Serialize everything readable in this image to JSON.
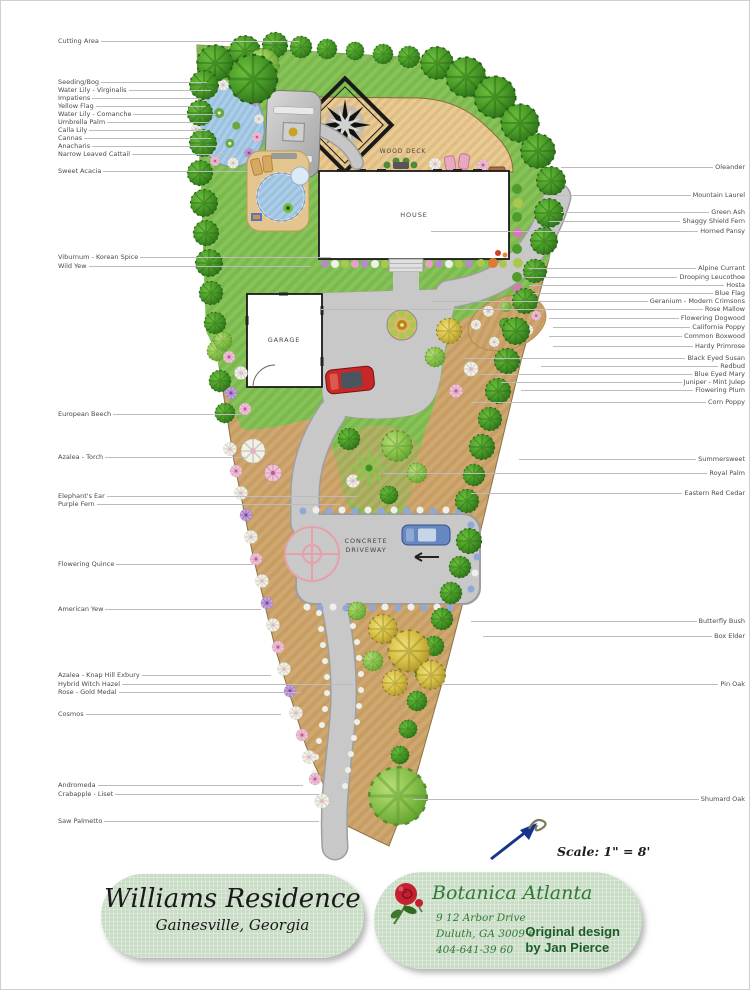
{
  "plan": {
    "scale_text": "Scale: 1\" = 8'",
    "structures": {
      "house": "HOUSE",
      "garage": "GARAGE",
      "wood_deck": "WOOD DECK",
      "driveway_line1": "CONCRETE",
      "driveway_line2": "DRIVEWAY"
    },
    "plant_labels": {
      "left": [
        {
          "text": "Cutting Area",
          "y": 40,
          "to": 298
        },
        {
          "text": "Seeding/Bog",
          "y": 81,
          "to": 206
        },
        {
          "text": "Water Lily - Virginalis",
          "y": 89,
          "to": 210
        },
        {
          "text": "Impatiens",
          "y": 97,
          "to": 200
        },
        {
          "text": "Yellow Flag",
          "y": 105,
          "to": 205
        },
        {
          "text": "Water Lily - Comanche",
          "y": 113,
          "to": 215
        },
        {
          "text": "Umbrella Palm",
          "y": 121,
          "to": 210
        },
        {
          "text": "Calla Lily",
          "y": 129,
          "to": 206
        },
        {
          "text": "Cannas",
          "y": 137,
          "to": 210
        },
        {
          "text": "Anacharis",
          "y": 145,
          "to": 216
        },
        {
          "text": "Narrow Leaved Cattail",
          "y": 153,
          "to": 230
        },
        {
          "text": "Sweet Acacia",
          "y": 170,
          "to": 246
        },
        {
          "text": "Viburnum - Korean Spice",
          "y": 256,
          "to": 330
        },
        {
          "text": "Wild Yew",
          "y": 265,
          "to": 310
        },
        {
          "text": "European Beech",
          "y": 413,
          "to": 240
        },
        {
          "text": "Azalea - Torch",
          "y": 456,
          "to": 244
        },
        {
          "text": "Elephant's Ear",
          "y": 495,
          "to": 356
        },
        {
          "text": "Purple Fern",
          "y": 503,
          "to": 340
        },
        {
          "text": "Flowering Quince",
          "y": 563,
          "to": 252
        },
        {
          "text": "American Yew",
          "y": 608,
          "to": 260
        },
        {
          "text": "Azalea - Knap Hill Exbury",
          "y": 674,
          "to": 270
        },
        {
          "text": "Hybrid Witch Hazel",
          "y": 683,
          "to": 352
        },
        {
          "text": "Rose - Gold Medal",
          "y": 691,
          "to": 300
        },
        {
          "text": "Cosmos",
          "y": 713,
          "to": 280
        },
        {
          "text": "Andromeda",
          "y": 784,
          "to": 302
        },
        {
          "text": "Crabapple - Liset",
          "y": 793,
          "to": 318
        },
        {
          "text": "Saw Palmetto",
          "y": 820,
          "to": 318
        }
      ],
      "right": [
        {
          "text": "Oleander",
          "y": 166,
          "from": 560
        },
        {
          "text": "Mountain Laurel",
          "y": 194,
          "from": 545
        },
        {
          "text": "Green Ash",
          "y": 211,
          "from": 560
        },
        {
          "text": "Shaggy Shield Fern",
          "y": 220,
          "from": 548
        },
        {
          "text": "Horned Pansy",
          "y": 230,
          "from": 430
        },
        {
          "text": "Alpine Currant",
          "y": 267,
          "from": 528
        },
        {
          "text": "Drooping Leucothoe",
          "y": 276,
          "from": 524
        },
        {
          "text": "Hosta",
          "y": 284,
          "from": 528
        },
        {
          "text": "Blue Flag",
          "y": 292,
          "from": 532
        },
        {
          "text": "Geranium - Modern Crimsons",
          "y": 300,
          "from": 430
        },
        {
          "text": "Rose Mallow",
          "y": 308,
          "from": 320
        },
        {
          "text": "Flowering Dogwood",
          "y": 317,
          "from": 548
        },
        {
          "text": "California Poppy",
          "y": 326,
          "from": 552
        },
        {
          "text": "Common Boxwood",
          "y": 335,
          "from": 548
        },
        {
          "text": "Hardy Primrose",
          "y": 345,
          "from": 552
        },
        {
          "text": "Black Eyed Susan",
          "y": 357,
          "from": 462
        },
        {
          "text": "Redbud",
          "y": 365,
          "from": 540
        },
        {
          "text": "Blue Eyed Mary",
          "y": 373,
          "from": 480
        },
        {
          "text": "Juniper - Mint Julep",
          "y": 381,
          "from": 500
        },
        {
          "text": "Flowering Plum",
          "y": 389,
          "from": 520
        },
        {
          "text": "Corn Poppy",
          "y": 401,
          "from": 470
        },
        {
          "text": "Summersweet",
          "y": 458,
          "from": 518
        },
        {
          "text": "Royal Palm",
          "y": 472,
          "from": 382
        },
        {
          "text": "Eastern Red Cedar",
          "y": 492,
          "from": 470
        },
        {
          "text": "Butterfly Bush",
          "y": 620,
          "from": 470
        },
        {
          "text": "Box Elder",
          "y": 635,
          "from": 482
        },
        {
          "text": "Pin Oak",
          "y": 683,
          "from": 440
        },
        {
          "text": "Shumard Oak",
          "y": 798,
          "from": 412
        }
      ]
    }
  },
  "title_block": {
    "name": "Williams Residence",
    "location": "Gainesville, Georgia"
  },
  "designer_block": {
    "company": "Botanica Atlanta",
    "address1": "9 12 Arbor Drive",
    "address2": "Duluth, GA  3009 6",
    "phone": "404-641-39 60",
    "credit1": "Original design",
    "credit2": "by Jan Pierce"
  },
  "icons": {
    "rose": "rose-icon",
    "north_arrow": "north-arrow-icon",
    "compass_star": "compass-star-motif"
  },
  "colors": {
    "lawn": "#7cb84d",
    "mulch": "#c79d63",
    "driveway": "#c8c8c8",
    "deck": "#e9cb96",
    "water": "#9bc1de",
    "pill_bg": "#c9dcc5",
    "brand_green": "#2f7a35",
    "credit_green": "#1d5c28",
    "north_arrow_blue": "#16348c",
    "red_car": "#c62828",
    "blue_car": "#6688c0"
  }
}
